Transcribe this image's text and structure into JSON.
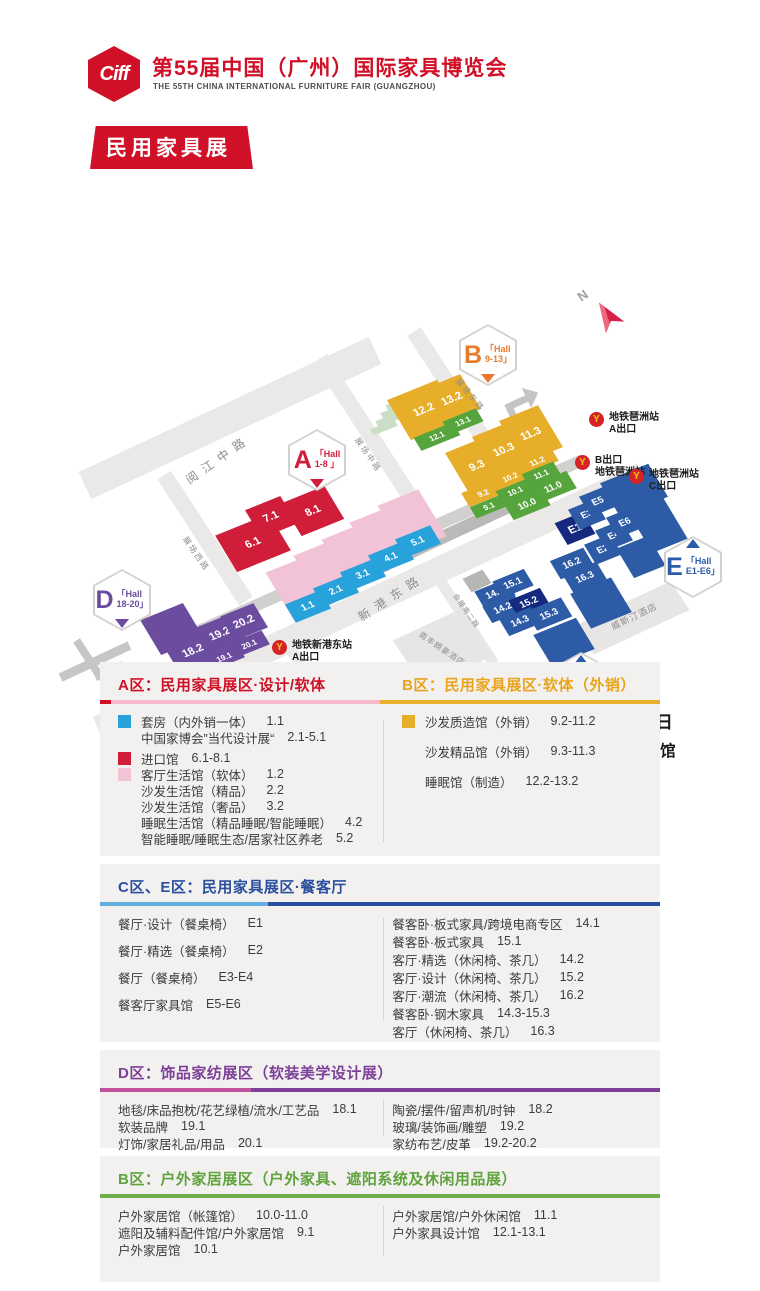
{
  "header": {
    "logo": "Ciff",
    "title": "第55届中国（广州）国际家具博览会",
    "subtitle": "THE 55TH CHINA INTERNATIONAL FURNITURE FAIR (GUANGZHOU)",
    "banner": "民用家具展"
  },
  "colors": {
    "cyan": "#27a2db",
    "red": "#cf1d3a",
    "pink": "#f2c3d6",
    "yellow": "#e7ae2a",
    "green": "#55a43c",
    "blue": "#2d5ba6",
    "navy": "#15297e",
    "purple": "#6b4c9f",
    "brand": "#d01027",
    "gold": "#e9a41d",
    "ce_blue": "#2b4f9e",
    "d_purple": "#7d3f98",
    "out_green": "#5fa33d"
  },
  "map": {
    "compass": "N",
    "venue": {
      "date": "2025年3月18-21日",
      "place1": "广州琶洲·广交会展馆",
      "place2": "保利世贸博览馆"
    },
    "badges": [
      {
        "letter": "A",
        "line1": "「Hall",
        "line2": "1-8 」",
        "x": 317,
        "y": 310,
        "color": "#cf1d3a",
        "pointer": "bottom"
      },
      {
        "letter": "B",
        "line1": "「Hall",
        "line2": "9-13」",
        "x": 488,
        "y": 205,
        "color": "#e87b2b",
        "pointer": "bottom"
      },
      {
        "letter": "C",
        "line1": "「Hall",
        "line2": "14-16」",
        "x": 581,
        "y": 533,
        "color": "#2b5cab",
        "pointer": "top"
      },
      {
        "letter": "D",
        "line1": "「Hall",
        "line2": "18-20」",
        "x": 122,
        "y": 450,
        "color": "#6b4c9f",
        "pointer": "bottom"
      },
      {
        "letter": "E",
        "line1": "「Hall",
        "line2": "E1-E6」",
        "x": 693,
        "y": 417,
        "color": "#2b5cab",
        "pointer": "top"
      }
    ],
    "halls": [
      {
        "l": "12.2",
        "c": "yellow",
        "x": 424,
        "y": 260,
        "w": 54,
        "h": 46
      },
      {
        "l": "13.2",
        "c": "yellow",
        "x": 452,
        "y": 249,
        "w": 40,
        "h": 40
      },
      {
        "l": "12.1",
        "c": "green",
        "x": 437,
        "y": 286,
        "w": 42,
        "h": 15
      },
      {
        "l": "13.1",
        "c": "green",
        "x": 463,
        "y": 271,
        "w": 36,
        "h": 15
      },
      {
        "l": "9.3",
        "c": "yellow",
        "x": 477,
        "y": 316,
        "w": 42,
        "h": 48
      },
      {
        "l": "10.3",
        "c": "yellow",
        "x": 504,
        "y": 300,
        "w": 42,
        "h": 48
      },
      {
        "l": "11.3",
        "c": "yellow",
        "x": 531,
        "y": 284,
        "w": 42,
        "h": 48
      },
      {
        "l": "9.2",
        "c": "yellow",
        "x": 483,
        "y": 343,
        "w": 38,
        "h": 16
      },
      {
        "l": "10.2",
        "c": "yellow",
        "x": 510,
        "y": 327,
        "w": 38,
        "h": 16
      },
      {
        "l": "11.2",
        "c": "yellow",
        "x": 537,
        "y": 311,
        "w": 38,
        "h": 16
      },
      {
        "l": "9.1",
        "c": "green",
        "x": 489,
        "y": 356,
        "w": 34,
        "h": 13
      },
      {
        "l": "10.1",
        "c": "green",
        "x": 515,
        "y": 341,
        "w": 34,
        "h": 14
      },
      {
        "l": "11.1",
        "c": "green",
        "x": 541,
        "y": 324,
        "w": 34,
        "h": 14
      },
      {
        "l": "10.0",
        "c": "green",
        "x": 527,
        "y": 354,
        "w": 40,
        "h": 20
      },
      {
        "l": "11.0",
        "c": "green",
        "x": 553,
        "y": 337,
        "w": 40,
        "h": 20
      },
      {
        "l": "6.1",
        "c": "red",
        "x": 253,
        "y": 393,
        "w": 58,
        "h": 42
      },
      {
        "l": "7.1",
        "c": "red",
        "x": 271,
        "y": 367,
        "w": 38,
        "h": 32
      },
      {
        "l": "8.1",
        "c": "red",
        "x": 313,
        "y": 361,
        "w": 46,
        "h": 38
      },
      {
        "l": "1.2",
        "c": "pink",
        "x": 300,
        "y": 438,
        "w": 44,
        "h": 54
      },
      {
        "l": "2.2",
        "c": "pink",
        "x": 328,
        "y": 421,
        "w": 44,
        "h": 54
      },
      {
        "l": "3.2",
        "c": "pink",
        "x": 356,
        "y": 405,
        "w": 44,
        "h": 54
      },
      {
        "l": "4.2",
        "c": "pink",
        "x": 384,
        "y": 388,
        "w": 44,
        "h": 54
      },
      {
        "l": "5.2",
        "c": "pink",
        "x": 412,
        "y": 371,
        "w": 44,
        "h": 54
      },
      {
        "l": "1.1",
        "c": "cyan",
        "x": 308,
        "y": 456,
        "w": 38,
        "h": 21
      },
      {
        "l": "2.1",
        "c": "cyan",
        "x": 336,
        "y": 440,
        "w": 38,
        "h": 21
      },
      {
        "l": "3.1",
        "c": "cyan",
        "x": 363,
        "y": 424,
        "w": 38,
        "h": 21
      },
      {
        "l": "4.1",
        "c": "cyan",
        "x": 391,
        "y": 407,
        "w": 38,
        "h": 21
      },
      {
        "l": "5.1",
        "c": "cyan",
        "x": 418,
        "y": 391,
        "w": 38,
        "h": 21
      },
      {
        "l": "",
        "c": "blue",
        "x": 634,
        "y": 340,
        "w": 52,
        "h": 38
      },
      {
        "l": "",
        "c": "blue",
        "x": 657,
        "y": 374,
        "w": 38,
        "h": 50
      },
      {
        "l": "",
        "c": "blue",
        "x": 641,
        "y": 407,
        "w": 34,
        "h": 34
      },
      {
        "l": "E1",
        "c": "blue",
        "x": 575,
        "y": 378,
        "w": 30,
        "h": 25,
        "d": 1
      },
      {
        "l": "E3",
        "c": "blue",
        "x": 587,
        "y": 364,
        "w": 28,
        "h": 23
      },
      {
        "l": "E5",
        "c": "blue",
        "x": 598,
        "y": 351,
        "w": 28,
        "h": 23
      },
      {
        "l": "E2",
        "c": "blue",
        "x": 603,
        "y": 399,
        "w": 28,
        "h": 23
      },
      {
        "l": "E4",
        "c": "blue",
        "x": 614,
        "y": 385,
        "w": 28,
        "h": 23
      },
      {
        "l": "E6",
        "c": "blue",
        "x": 625,
        "y": 372,
        "w": 28,
        "h": 23
      },
      {
        "l": "16.2",
        "c": "blue",
        "x": 572,
        "y": 413,
        "w": 36,
        "h": 21
      },
      {
        "l": "16.3",
        "c": "blue",
        "x": 585,
        "y": 427,
        "w": 36,
        "h": 21
      },
      {
        "l": "",
        "c": "blue",
        "x": 601,
        "y": 453,
        "w": 44,
        "h": 40
      },
      {
        "l": "14.1",
        "c": "blue",
        "x": 495,
        "y": 443,
        "w": 34,
        "h": 19
      },
      {
        "l": "15.1",
        "c": "blue",
        "x": 513,
        "y": 433,
        "w": 34,
        "h": 19
      },
      {
        "l": "14.2",
        "c": "blue",
        "x": 503,
        "y": 458,
        "w": 34,
        "h": 19
      },
      {
        "l": "15.2",
        "c": "blue",
        "x": 529,
        "y": 452,
        "w": 34,
        "h": 19,
        "d": 1
      },
      {
        "l": "14.3",
        "c": "blue",
        "x": 520,
        "y": 471,
        "w": 34,
        "h": 19
      },
      {
        "l": "15.3",
        "c": "blue",
        "x": 549,
        "y": 464,
        "w": 38,
        "h": 22
      },
      {
        "l": "",
        "c": "blue",
        "x": 564,
        "y": 492,
        "w": 46,
        "h": 36
      },
      {
        "l": "",
        "c": "purple",
        "x": 172,
        "y": 479,
        "w": 46,
        "h": 40
      },
      {
        "l": "18.2",
        "c": "purple",
        "x": 193,
        "y": 501,
        "w": 46,
        "h": 34
      },
      {
        "l": "19.2",
        "c": "purple",
        "x": 220,
        "y": 484,
        "w": 40,
        "h": 30
      },
      {
        "l": "20.2",
        "c": "purple",
        "x": 244,
        "y": 472,
        "w": 36,
        "h": 28
      },
      {
        "l": "18.1",
        "c": "purple",
        "x": 198,
        "y": 520,
        "w": 40,
        "h": 16
      },
      {
        "l": "19.1",
        "c": "purple",
        "x": 224,
        "y": 507,
        "w": 36,
        "h": 16
      },
      {
        "l": "20.1",
        "c": "purple",
        "x": 249,
        "y": 494,
        "w": 36,
        "h": 16
      }
    ],
    "road_labels": [
      {
        "t": "阅江中路",
        "x": 218,
        "y": 309,
        "a": -35,
        "fs": 12,
        "ls": 7
      },
      {
        "t": "展场西路",
        "x": 196,
        "y": 404,
        "a": 55,
        "fs": 8,
        "ls": 2
      },
      {
        "t": "展场中路",
        "x": 368,
        "y": 305,
        "a": 55,
        "fs": 8,
        "ls": 2
      },
      {
        "t": "展场东路",
        "x": 470,
        "y": 245,
        "a": 50,
        "fs": 8,
        "ls": 2
      },
      {
        "t": "新港东路",
        "x": 391,
        "y": 447,
        "a": -33,
        "fs": 12,
        "ls": 7
      },
      {
        "t": "会展南一路",
        "x": 325,
        "y": 554,
        "a": 55,
        "fs": 7,
        "ls": 1
      },
      {
        "t": "会展南二路",
        "x": 466,
        "y": 461,
        "a": 55,
        "fs": 7,
        "ls": 1
      }
    ],
    "building_labels": [
      {
        "t": "南丰朗豪酒店",
        "x": 442,
        "y": 499,
        "a": 34,
        "fs": 8,
        "ls": 1
      },
      {
        "t": "威斯汀酒店",
        "x": 634,
        "y": 466,
        "a": -26,
        "fs": 9,
        "ls": 1
      }
    ],
    "metro": [
      {
        "x": 589,
        "y": 262,
        "lines": [
          "地铁琶洲站",
          "A出口"
        ]
      },
      {
        "x": 575,
        "y": 305,
        "lines": [
          "B出口",
          "地铁琶洲站"
        ]
      },
      {
        "x": 629,
        "y": 319,
        "lines": [
          "地铁琶洲站",
          "C出口"
        ]
      },
      {
        "x": 272,
        "y": 490,
        "lines": [
          "地铁新港东站",
          "A出口"
        ]
      },
      {
        "x": 329,
        "y": 519,
        "lines": [
          "地铁新港东站",
          "F出口"
        ]
      }
    ]
  },
  "legend": {
    "sections": [
      {
        "id": "A",
        "title": "A区：民用家具展区·设计/软体",
        "items": [
          {
            "sw": "cyan",
            "label": "套房（内外销一体）",
            "hall": "1.1"
          },
          {
            "sw": "",
            "label": "中国家博会”当代设计展“",
            "hall": "2.1-5.1"
          },
          {
            "sw": "red",
            "label": "进口馆",
            "hall": "6.1-8.1",
            "gap": 1
          },
          {
            "sw": "pink",
            "label": "客厅生活馆（软体）",
            "hall": "1.2"
          },
          {
            "sw": "",
            "label": "沙发生活馆（精品）",
            "hall": "2.2"
          },
          {
            "sw": "",
            "label": "沙发生活馆（奢品）",
            "hall": "3.2"
          },
          {
            "sw": "",
            "label": "睡眠生活馆（精品睡眠/智能睡眠）",
            "hall": "4.2"
          },
          {
            "sw": "",
            "label": "智能睡眠/睡眠生态/居家社区养老",
            "hall": "5.2"
          }
        ]
      },
      {
        "id": "B",
        "title": "B区：民用家具展区·软体（外销）",
        "items": [
          {
            "sw": "yellow",
            "label": "沙发质造馆（外销）",
            "hall": "9.2-11.2"
          },
          {
            "sw": "",
            "label": "沙发精品馆（外销）",
            "hall": "9.3-11.3"
          },
          {
            "sw": "",
            "label": "睡眠馆（制造）",
            "hall": "12.2-13.2"
          }
        ]
      },
      {
        "id": "CE",
        "title": "C区、E区：民用家具展区·餐客厅",
        "items_left": [
          {
            "label": "餐厅·设计（餐桌椅）",
            "hall": "E1"
          },
          {
            "label": "餐厅·精选（餐桌椅）",
            "hall": "E2"
          },
          {
            "label": "餐厅（餐桌椅）",
            "hall": "E3-E4"
          },
          {
            "label": "餐客厅家具馆",
            "hall": "E5-E6"
          }
        ],
        "items_right": [
          {
            "label": "餐客卧·板式家具/跨境电商专区",
            "hall": "14.1"
          },
          {
            "label": "餐客卧·板式家具",
            "hall": "15.1"
          },
          {
            "label": "客厅·精选（休闲椅、茶几）",
            "hall": "14.2"
          },
          {
            "label": "客厅·设计（休闲椅、茶几）",
            "hall": "15.2"
          },
          {
            "label": "客厅·潮流（休闲椅、茶几）",
            "hall": "16.2"
          },
          {
            "label": "餐客卧·钢木家具",
            "hall": "14.3-15.3"
          },
          {
            "label": "客厅（休闲椅、茶几）",
            "hall": "16.3"
          }
        ]
      },
      {
        "id": "D",
        "title": "D区：饰品家纺展区（软装美学设计展）",
        "items_left": [
          {
            "label": "地毯/床品抱枕/花艺绿植/流水/工艺品",
            "hall": "18.1"
          },
          {
            "label": "软装品牌",
            "hall": "19.1"
          },
          {
            "label": "灯饰/家居礼品/用品",
            "hall": "20.1"
          }
        ],
        "items_right": [
          {
            "label": "陶瓷/摆件/留声机/时钟",
            "hall": "18.2"
          },
          {
            "label": "玻璃/装饰画/雕塑",
            "hall": "19.2"
          },
          {
            "label": "家纺布艺/皮革",
            "hall": "19.2-20.2"
          }
        ]
      },
      {
        "id": "OUT",
        "title": "B区：户外家居展区（户外家具、遮阳系统及休闲用品展）",
        "items_left": [
          {
            "label": "户外家居馆（帐篷馆）",
            "hall": "10.0-11.0"
          },
          {
            "label": "遮阳及辅料配件馆/户外家居馆",
            "hall": "9.1"
          },
          {
            "label": "户外家居馆",
            "hall": "10.1"
          }
        ],
        "items_right": [
          {
            "label": "户外家居馆/户外休闲馆",
            "hall": "11.1"
          },
          {
            "label": "户外家具设计馆",
            "hall": "12.1-13.1"
          }
        ]
      }
    ]
  }
}
